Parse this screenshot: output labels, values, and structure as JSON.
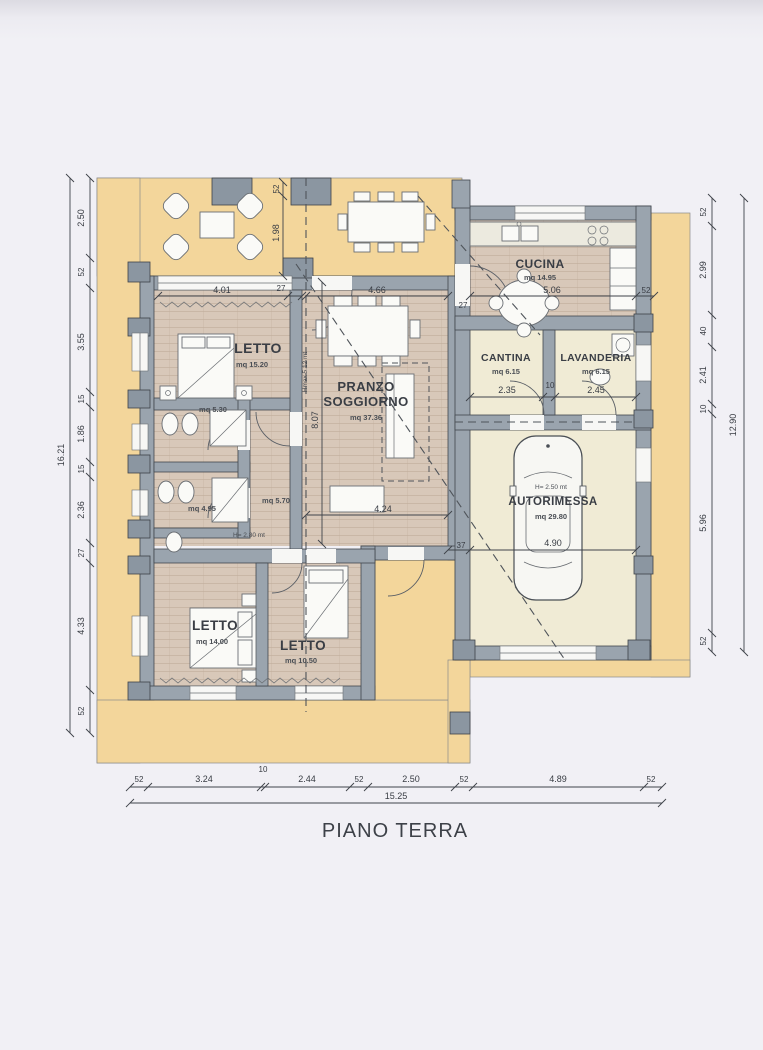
{
  "title": "PIANO TERRA",
  "rooms": {
    "letto1": {
      "label": "LETTO",
      "area": "mq 15.20"
    },
    "soggiorno": {
      "label_line1": "PRANZO",
      "label_line2": "SOGGIORNO",
      "area": "mq 37.36",
      "height_note": "Hmax 5.12 mt"
    },
    "cucina": {
      "label": "CUCINA",
      "area": "mq 14.95"
    },
    "cantina": {
      "label": "CANTINA",
      "area": "mq 6.15"
    },
    "lavanderia": {
      "label": "LAVANDERIA",
      "area": "mq 6.15"
    },
    "autorimessa": {
      "label": "AUTORIMESSA",
      "area": "mq 29.80",
      "height_note": "H= 2.50 mt"
    },
    "letto2": {
      "label": "LETTO",
      "area": "mq 14.00"
    },
    "letto3": {
      "label": "LETTO",
      "area": "mq 10.50"
    },
    "bagno1": {
      "area": "mq 5.30"
    },
    "bagno2": {
      "area": "mq 4.95"
    },
    "disimpegno": {
      "area": "mq 5.70",
      "height_note": "H= 2.80 mt"
    }
  },
  "dimensions": {
    "left_chain": {
      "total": "16.21",
      "segments": [
        "2.50",
        "52",
        "3.55",
        "15",
        "1.86",
        "15",
        "2.36",
        "27",
        "4.33",
        "52"
      ]
    },
    "right_chain": {
      "total": "12.90",
      "segments": [
        "52",
        "2.99",
        "40",
        "2.41",
        "10",
        "5.96",
        "52"
      ]
    },
    "bottom_chain": {
      "total": "15.25",
      "segments": [
        "52",
        "3.24",
        "10",
        "2.44",
        "52",
        "2.50",
        "52",
        "4.89",
        "52"
      ]
    },
    "interior": {
      "letto1_width": "4.01",
      "wall_a": "27",
      "soggiorno_width": "4.66",
      "wall_b": "27",
      "cucina_width": "5.06",
      "wall_c": "52",
      "patio_depth": "1.98",
      "patio_wall": "52",
      "soggiorno_depth": "8.07",
      "cantina_width": "2.35",
      "wall_d": "10",
      "lavanderia_width": "2.45",
      "soggiorno_lower_width": "4.24",
      "garage_wall": "37",
      "garage_width": "4.90"
    }
  },
  "colors": {
    "paper": "#f1f0f5",
    "patio_yellow": "#f3d69b",
    "wall_gray": "#9aa4ae",
    "floor_wood": "#d8c8b9",
    "floor_cream": "#f0ebd5",
    "line": "#3f434a"
  }
}
